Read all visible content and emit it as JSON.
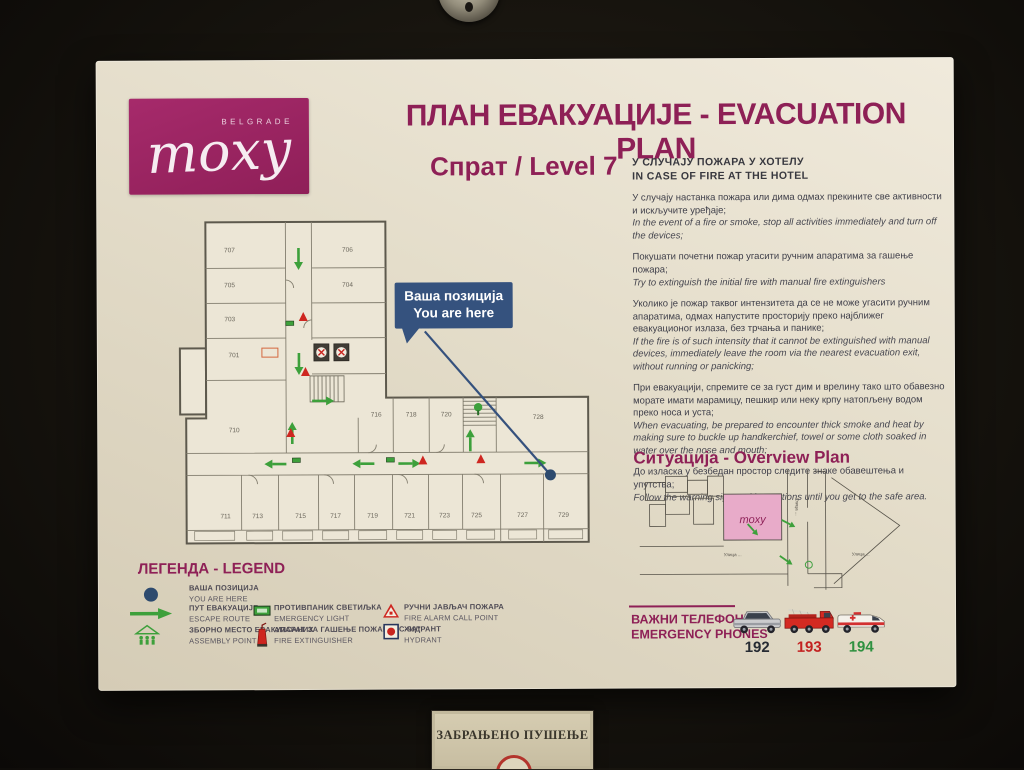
{
  "colors": {
    "accent": "#8e2056",
    "logo_bg": "#a12766",
    "callout_blue": "#35527e",
    "route_green": "#3da03b",
    "alarm_red": "#ce2620",
    "overview_pink": "#e8abc9",
    "you_are_here_blue": "#2d4a6e"
  },
  "sign": {
    "logo": {
      "city": "BELGRADE",
      "brand": "moxy"
    },
    "title": "ПЛАН ЕВАКУАЦИЈЕ - EVACUATION PLAN",
    "floor_label": "Спрат / Level 7",
    "instructions": {
      "heading_sr": "У СЛУЧАЈУ ПОЖАРА У ХОТЕЛУ",
      "heading_en": "IN CASE OF FIRE AT THE HOTEL",
      "items": [
        {
          "sr": "У случају настанка пожара или дима одмах прекините све активности и искључите уређаје;",
          "en": "In the event of a fire or smoke, stop all activities immediately and turn off the devices;"
        },
        {
          "sr": "Покушати почетни пожар угасити ручним апаратима за гашење пожара;",
          "en": "Try to extinguish the initial fire with manual fire extinguishers"
        },
        {
          "sr": "Уколико је пожар таквог интензитета да се не може угасити ручним апаратима, одмах напустите просторију преко најближег евакуационог излаза, без трчања и панике;",
          "en": "If the fire is of such intensity that it cannot be extinguished with manual devices, immediately leave the room via the nearest evacuation exit, without running or panicking;"
        },
        {
          "sr": "При евакуацији, спремите се за густ дим и врелину тако што обавезно морате имати марамицу, пешкир или неку крпу натопљену водом преко носа и уста;",
          "en": "When evacuating, be prepared to encounter thick smoke and heat by making sure to buckle up handkerchief, towel or some cloth soaked in water over the nose and mouth;"
        },
        {
          "sr": "До изласка у безбедан простор следите знаке обавештења и упутства;",
          "en": "Follow the warning sign and instructions until you get to the safe area."
        }
      ]
    },
    "callout": {
      "line1": "Ваша позиција",
      "line2": "You are here"
    },
    "plan": {
      "left_wing_rooms": [
        "707",
        "705",
        "703",
        "701",
        "710"
      ],
      "right_wing_rooms": [
        "706",
        "704"
      ],
      "top_row_rooms": [
        "716",
        "718",
        "720",
        "728"
      ],
      "bottom_row_rooms": [
        "711",
        "713",
        "715",
        "717",
        "719",
        "721",
        "723",
        "725",
        "727",
        "729"
      ]
    },
    "overview": {
      "heading": "Ситуација - Overview Plan",
      "building": "moxy",
      "streets": [
        "Улица ...",
        "Улица ...",
        "Улица ..."
      ]
    },
    "legend": {
      "heading": "ЛЕГЕНДА - LEGEND",
      "items": [
        {
          "sr": "ВАША ПОЗИЦИЈА",
          "en": "YOU ARE HERE"
        },
        {
          "sr": "ПУТ ЕВАКУАЦИЈЕ",
          "en": "ESCAPE ROUTE"
        },
        {
          "sr": "ЗБОРНО МЕСТО ЕВАКУИСАНИХ",
          "en": "ASSEMBLY POINT"
        },
        {
          "sr": "ПРОТИВПАНИК СВЕТИЉКА",
          "en": "EMERGENCY LIGHT"
        },
        {
          "sr": "АПАРАТ ЗА ГАШЕЊЕ ПОЖАРА \"С-9А\"",
          "en": "FIRE EXTINGUISHER"
        },
        {
          "sr": "РУЧНИ ЈАВЉАЧ ПОЖАРА",
          "en": "FIRE ALARM CALL POINT"
        },
        {
          "sr": "ХИДРАНТ",
          "en": "HYDRANT"
        }
      ]
    },
    "phones": {
      "heading_sr": "ВАЖНИ ТЕЛЕФОНИ",
      "heading_en": "EMERGENCY PHONES",
      "entries": [
        {
          "vehicle": "police-car",
          "number": "192",
          "color": "#262b33"
        },
        {
          "vehicle": "fire-truck",
          "number": "193",
          "color": "#c32120"
        },
        {
          "vehicle": "ambulance",
          "number": "194",
          "color": "#2f9140"
        }
      ]
    }
  },
  "plaque": {
    "text": "ЗАБРАЊЕНО ПУШЕЊЕ"
  }
}
